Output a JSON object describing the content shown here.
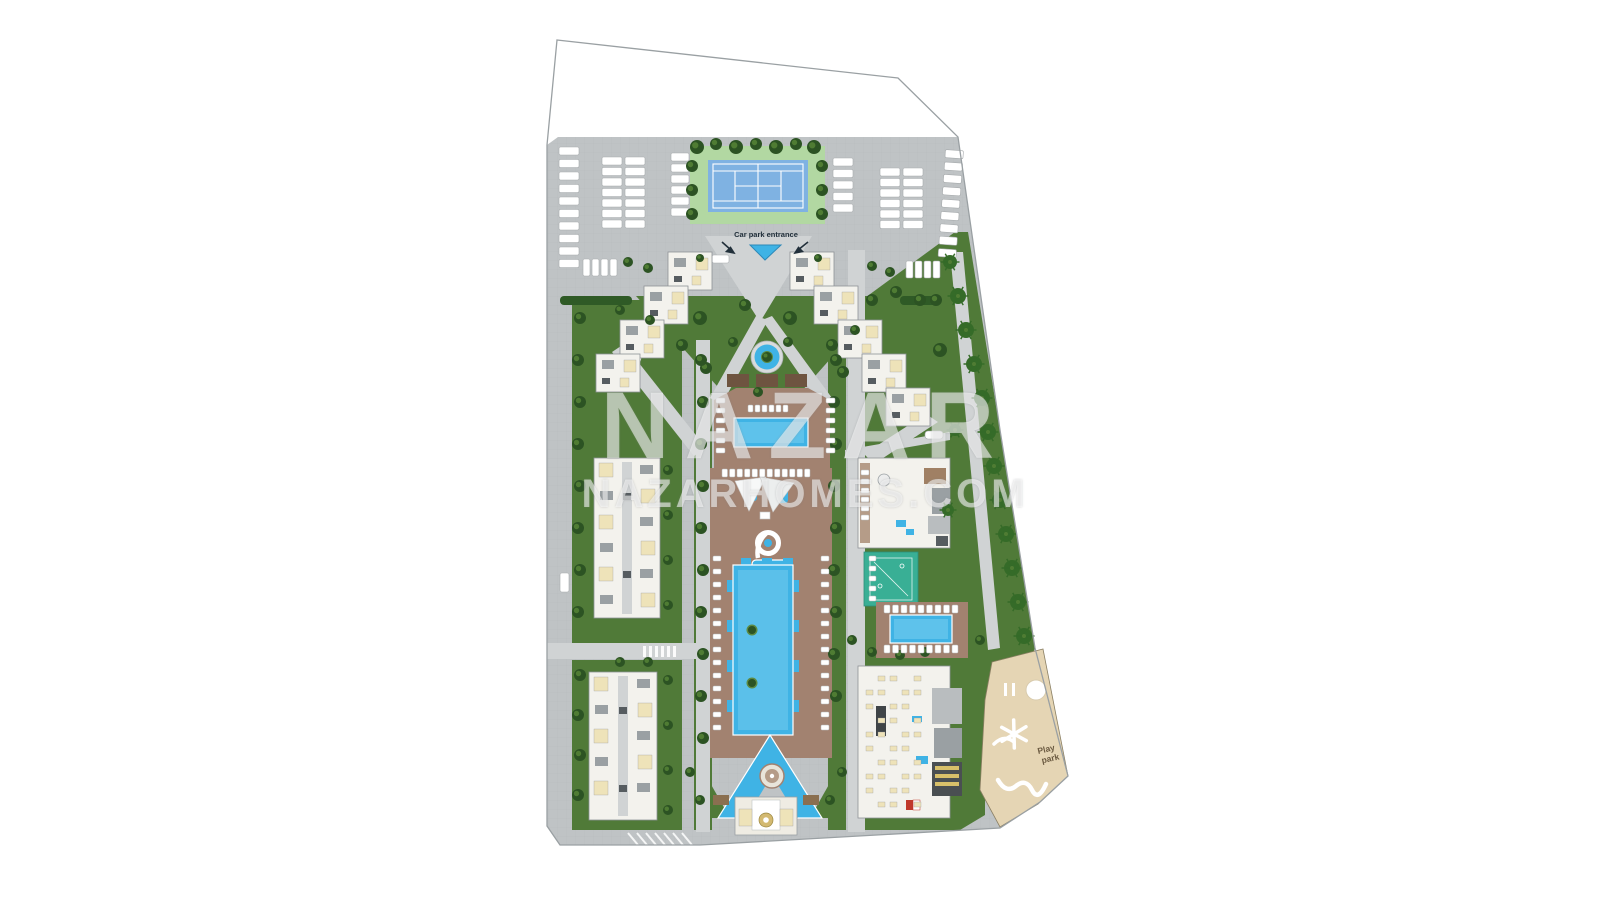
{
  "site_plan": {
    "labels": {
      "car_park_entrance": "Car park entrance",
      "play_park": "Play park",
      "play_park_line1": "Play",
      "play_park_line2": "park"
    },
    "watermark": {
      "line1": "NAZAR",
      "line2": "NAZARHOMES.COM"
    },
    "features": [
      "parking-lot",
      "tennis-court",
      "car-park-entrance-ramp",
      "v-shaped-apartment-buildings",
      "ornamental-fountain",
      "family-pool",
      "kids-pool-with-shade-sails",
      "spiral-water-slide",
      "main-swimming-pool",
      "triangle-pool",
      "entrance-pavilion",
      "clubhouse",
      "fitness-court",
      "secondary-pool",
      "social-facilities-building",
      "play-park",
      "landscaped-gardens"
    ],
    "colors": {
      "background": "#ffffff",
      "boundary": "#9aa0a3",
      "pavement": "#bfc3c5",
      "pavement_line": "#b2b6b8",
      "road": "#d0d3d4",
      "lawn": "#507a38",
      "lawn_light": "#5d8a42",
      "tree": "#2c5323",
      "tree_light": "#4f7c33",
      "palm": "#356b28",
      "hedge": "#2f5a26",
      "tennis_apron": "#b2d8a2",
      "tennis_court": "#7fb2e2",
      "court_line": "#ffffff",
      "pool": "#3fb3e5",
      "pool_light": "#8ed9f4",
      "pool_rim": "#ffffff",
      "deck": "#a28270",
      "deck_light": "#b59c88",
      "pergola": "#6e5440",
      "building": "#f3f2ed",
      "building_stroke": "#8e9296",
      "unit_cream": "#eee3b9",
      "roof_gray": "#9aa0a3",
      "roof_dark": "#565c60",
      "fitness_court": "#39af95",
      "play_park": "#e5d5b4",
      "play_stroke": "#8a7f63",
      "play_equipment": "#ffffff",
      "gold": "#d3b971",
      "gold_dark": "#9c8840",
      "label": "#22303b",
      "play_label": "#6b5a41",
      "watermark": "rgba(255,255,255,0.55)"
    }
  }
}
